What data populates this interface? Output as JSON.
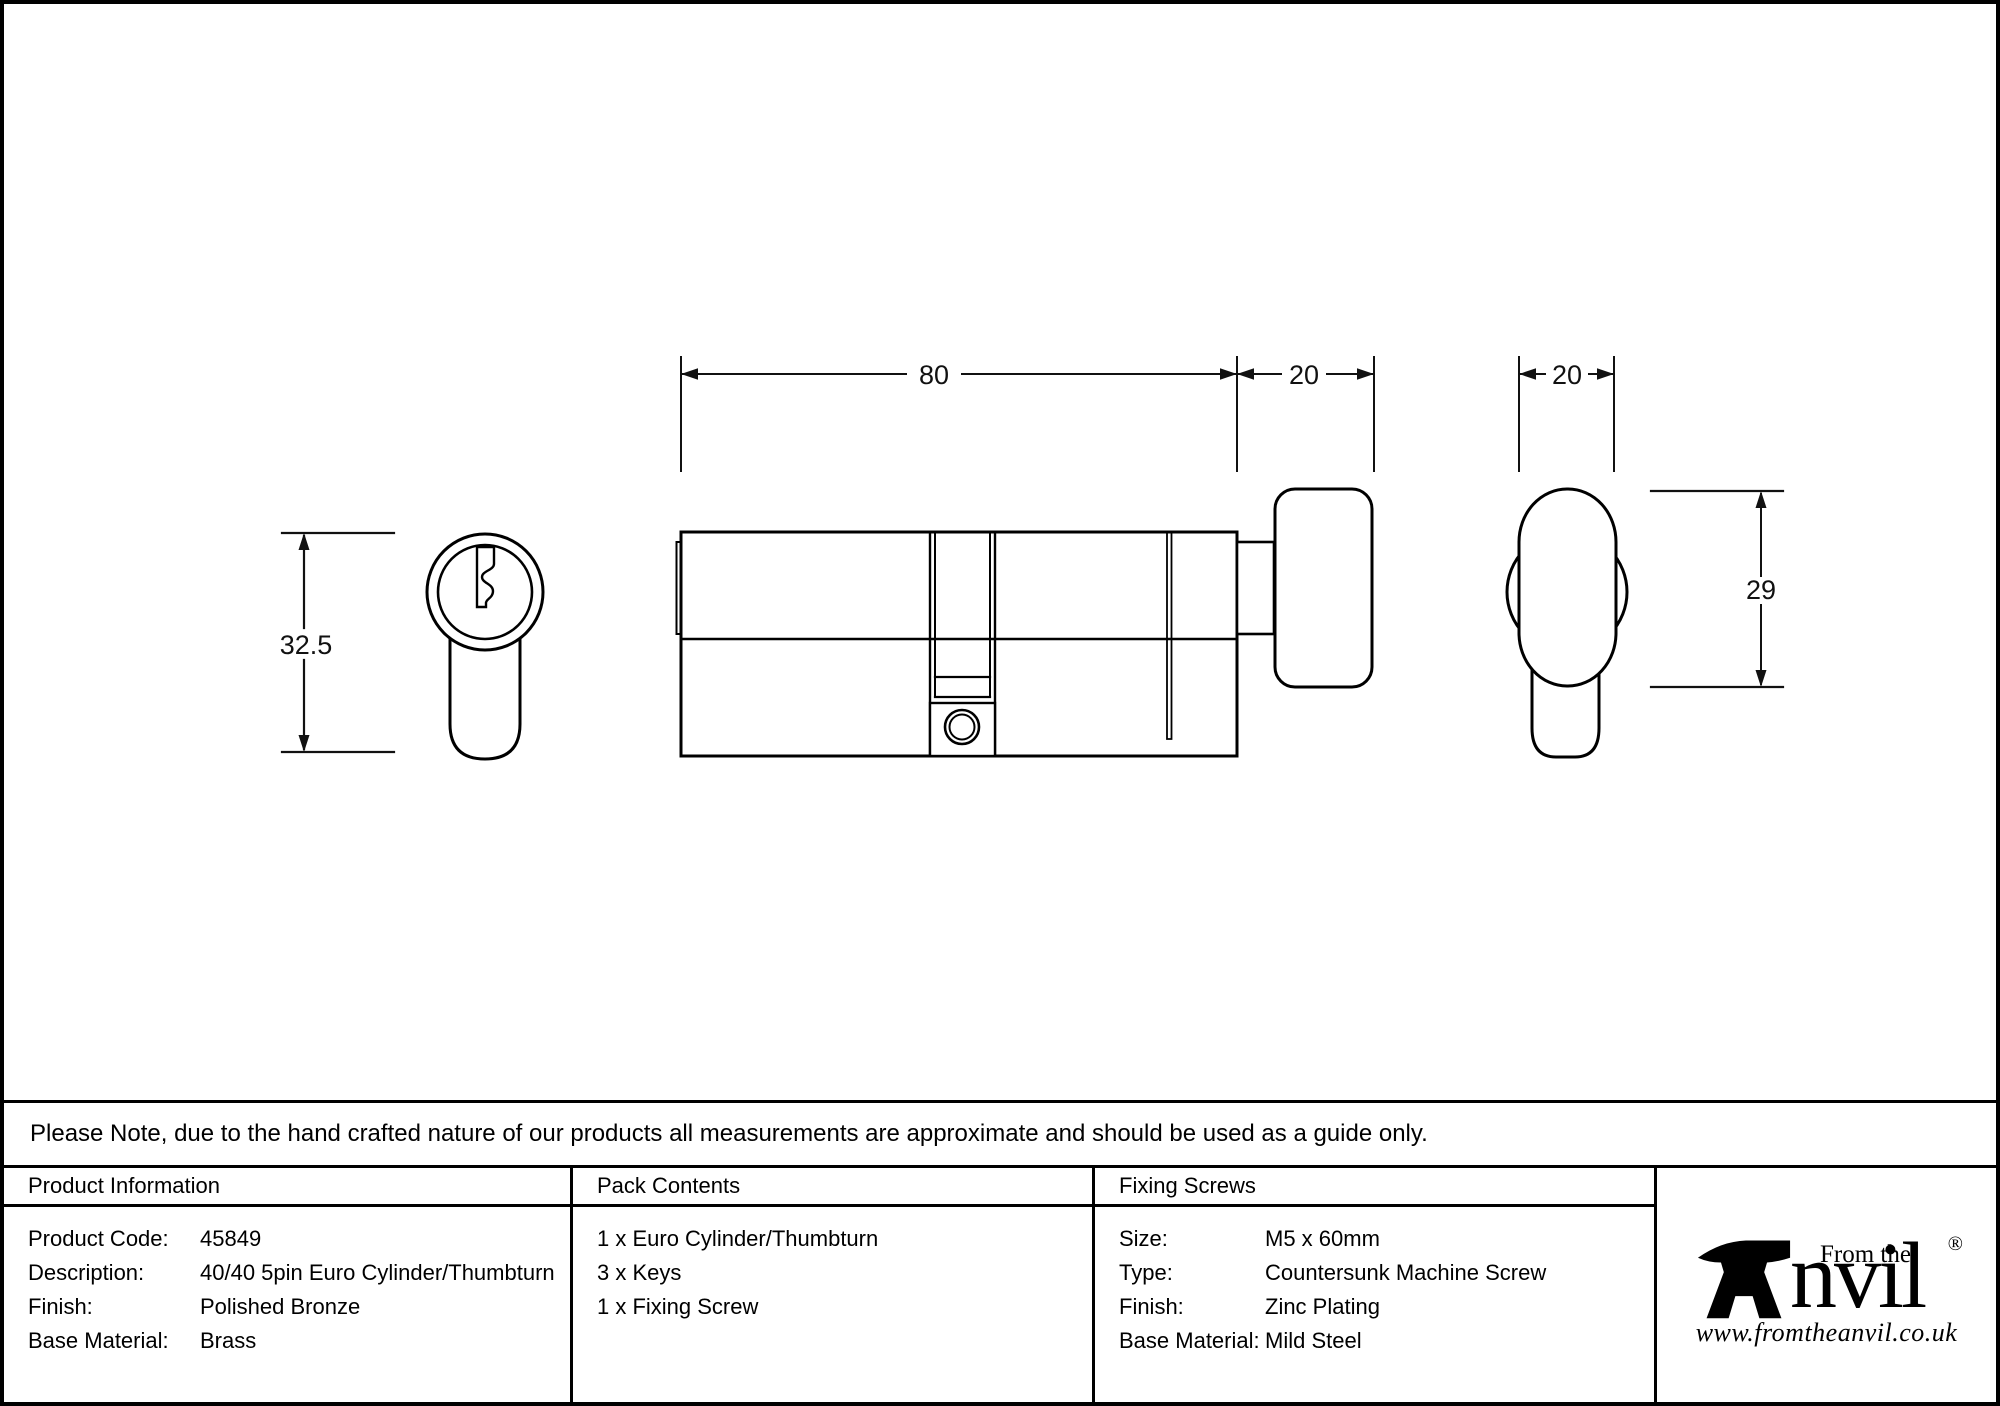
{
  "colors": {
    "ink": "#000000",
    "paper": "#ffffff"
  },
  "drawing": {
    "front_view": {
      "height_label": "32.5"
    },
    "side_view": {
      "body_length_label": "80",
      "thumbturn_length_label": "20"
    },
    "thumbturn_view": {
      "width_label": "20",
      "height_label": "29"
    }
  },
  "note": "Please Note, due to the hand crafted nature of our products all measurements are approximate and should be used as a guide only.",
  "table": {
    "product_information": {
      "header": "Product Information",
      "rows": [
        {
          "label": "Product Code:",
          "value": "45849"
        },
        {
          "label": "Description:",
          "value": "40/40 5pin Euro Cylinder/Thumbturn"
        },
        {
          "label": "Finish:",
          "value": "Polished Bronze"
        },
        {
          "label": "Base Material:",
          "value": "Brass"
        }
      ]
    },
    "pack_contents": {
      "header": "Pack Contents",
      "items": [
        "1 x Euro Cylinder/Thumbturn",
        "3 x Keys",
        "1 x Fixing Screw"
      ]
    },
    "fixing_screws": {
      "header": "Fixing Screws",
      "rows": [
        {
          "label": "Size:",
          "value": "M5 x 60mm"
        },
        {
          "label": "Type:",
          "value": "Countersunk Machine Screw"
        },
        {
          "label": "Finish:",
          "value": "Zinc Plating"
        },
        {
          "label": "Base Material:",
          "value": "Mild Steel"
        }
      ]
    }
  },
  "logo": {
    "brand": "Anvil",
    "brand_suffix": "nvil",
    "tagline": "From the",
    "registered_mark": "®",
    "website": "www.fromtheanvil.co.uk"
  }
}
